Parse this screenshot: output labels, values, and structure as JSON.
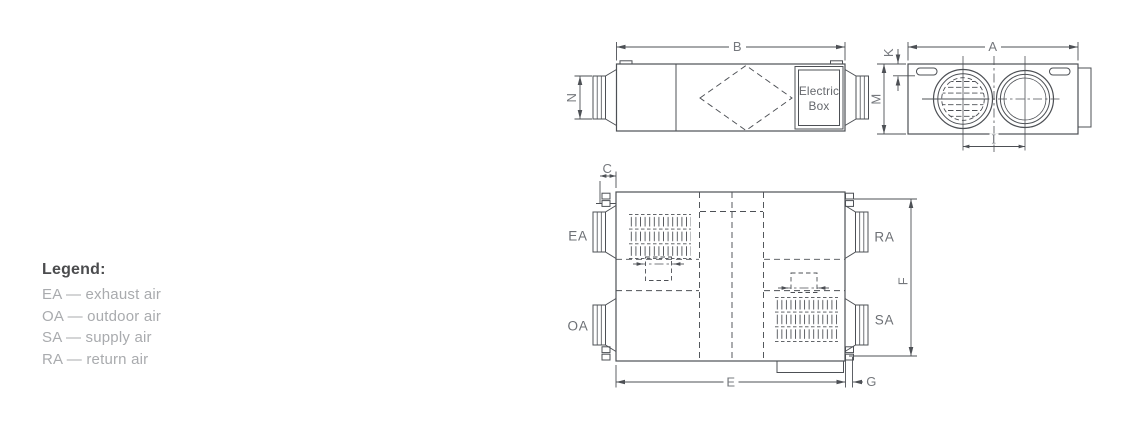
{
  "colors": {
    "line": "#4d5055",
    "dim_text": "#75787d",
    "port_text": "#6d7075",
    "box_text": "#64676c",
    "legend_title": "#4b4c4e",
    "legend_item": "#a9abae",
    "background": "#ffffff"
  },
  "legend": {
    "title": "Legend:",
    "items": [
      {
        "label": "EA — exhaust air"
      },
      {
        "label": "OA — outdoor air"
      },
      {
        "label": "SA — supply air"
      },
      {
        "label": "RA — return air"
      }
    ]
  },
  "side_view": {
    "dim_b": "B",
    "dim_n": "N",
    "electric_box_line1": "Electric",
    "electric_box_line2": "Box"
  },
  "end_view": {
    "dim_a": "A",
    "dim_k": "K",
    "dim_m": "M",
    "dim_i": "I"
  },
  "plan_view": {
    "dim_c": "C",
    "dim_e": "E",
    "dim_f": "F",
    "dim_g": "G",
    "port_ea": "EA",
    "port_oa": "OA",
    "port_ra": "RA",
    "port_sa": "SA"
  }
}
